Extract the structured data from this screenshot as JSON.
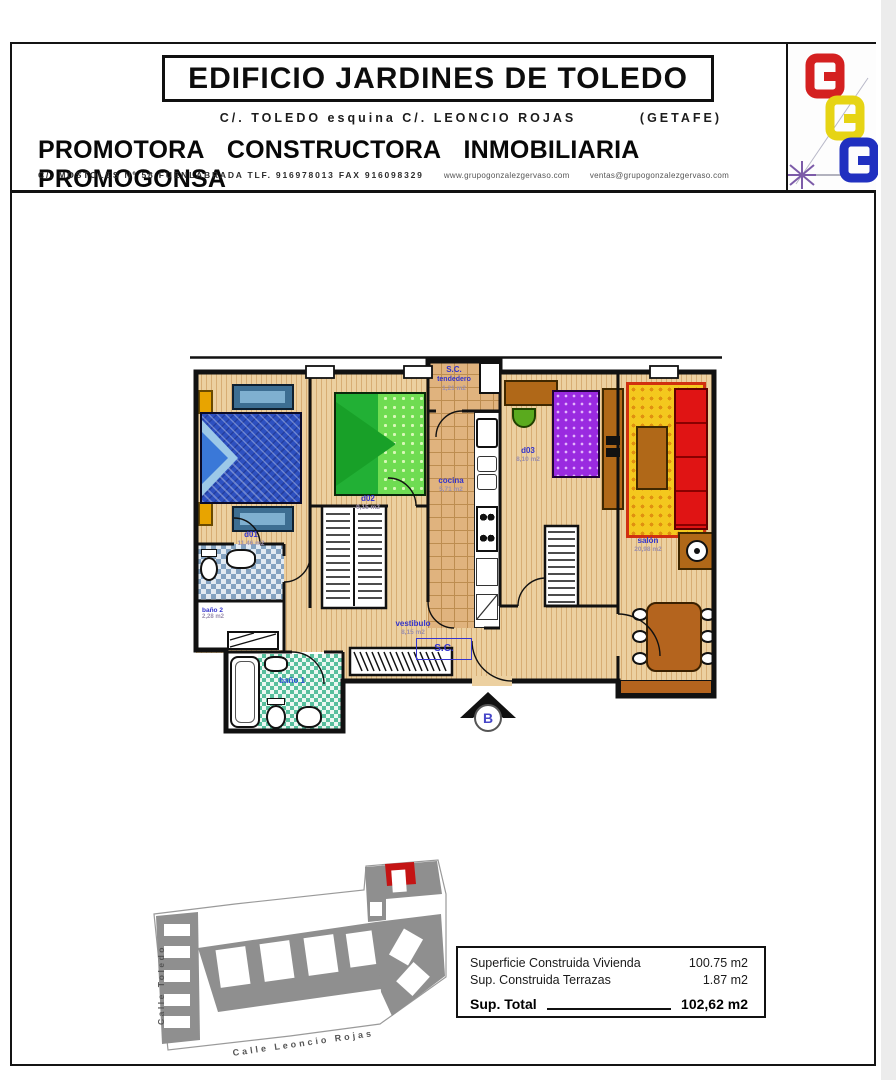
{
  "header": {
    "title": "EDIFICIO JARDINES DE TOLEDO",
    "address": "C/.  TOLEDO  esquina  C/.  LEONCIO  ROJAS",
    "city": "(GETAFE)",
    "company": "PROMOTORA CONSTRUCTORA INMOBILIARIA PROMOGONSA",
    "contact": "C/. MOSTOLES  Nº 58  FUENLABRADA  TLF. 916978013   FAX  916098329",
    "web": "www.grupogonzalezgervaso.com",
    "email": "ventas@grupogonzalezgervaso.com"
  },
  "plan": {
    "rooms": {
      "d01": {
        "label": "d01",
        "area": "11,46 m2"
      },
      "d02": {
        "label": "d02",
        "area": "9,15 m2"
      },
      "d03": {
        "label": "d03",
        "area": "8,10 m2"
      },
      "cocina": {
        "label": "cocina",
        "area": "5,71 m2"
      },
      "tendedero": {
        "label1": "S.C.",
        "label2": "tendedero",
        "area": "1,21 m2"
      },
      "salon": {
        "label": "salón",
        "area": "20,98 m2"
      },
      "vestibulo": {
        "label": "vestibulo",
        "area": "8,15 m2"
      },
      "sc_box": {
        "label": "S.C."
      },
      "bano1": {
        "label": "baño 1"
      },
      "bano2": {
        "label": "baño 2",
        "area": "2,28 m2"
      }
    },
    "entry_label": "B"
  },
  "site_plan": {
    "street_left": "Calle Toledo",
    "street_bottom": "Calle Leoncio Rojas"
  },
  "summary": {
    "rows": [
      {
        "label": "Superficie Construida Vivienda",
        "value": "100.75 m2"
      },
      {
        "label": "Sup. Construida Terrazas",
        "value": "1.87 m2"
      }
    ],
    "total_label": "Sup. Total",
    "total_value": "102,62 m2"
  },
  "colors": {
    "label_blue": "#3434cc",
    "logo_red": "#d42020",
    "logo_yellow": "#e6d414",
    "logo_blue": "#2030c0",
    "highlight_unit_red": "#c41414"
  }
}
